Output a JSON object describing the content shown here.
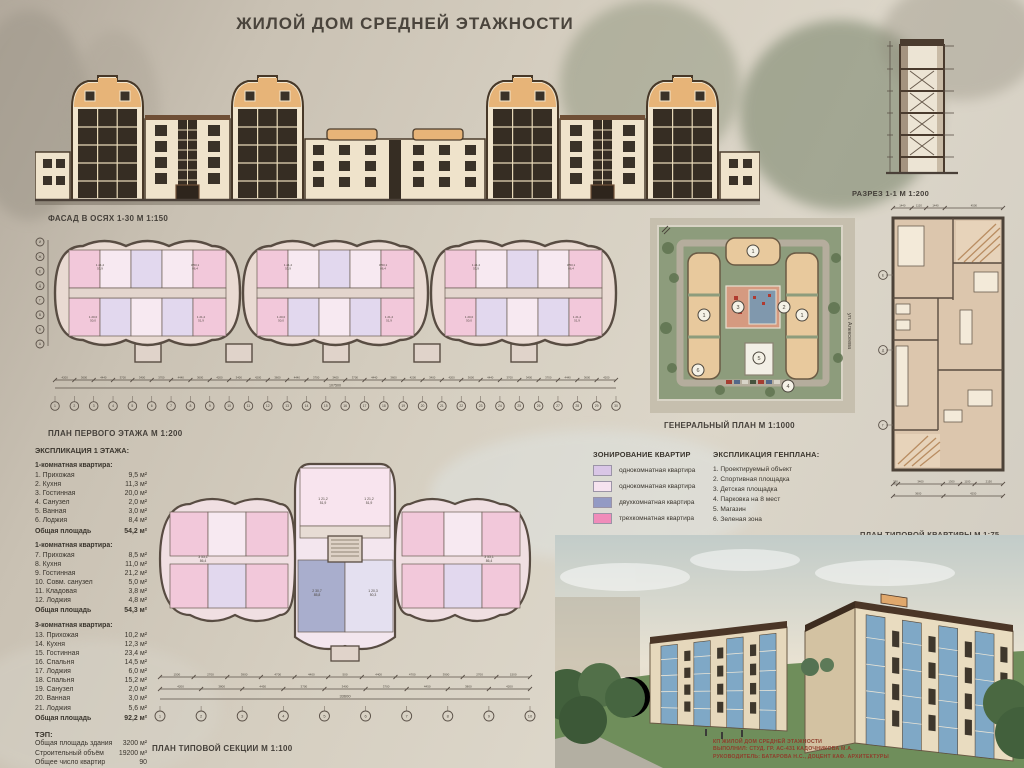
{
  "page": {
    "title": "ЖИЛОЙ ДОМ СРЕДНЕЙ ЭТАЖНОСТИ"
  },
  "facade": {
    "label": "ФАСАД В ОСЯХ 1-30 М 1:150"
  },
  "section_drawing": {
    "label": "РАЗРЕЗ 1-1 М 1:200"
  },
  "first_floor": {
    "label": "ПЛАН ПЕРВОГО ЭТАЖА М 1:200",
    "axes_h": [
      "1",
      "2",
      "3",
      "4",
      "5",
      "6",
      "7",
      "8",
      "9",
      "10",
      "11",
      "12",
      "13",
      "14",
      "15",
      "16",
      "17",
      "18",
      "19",
      "20",
      "21",
      "22",
      "23",
      "24",
      "25",
      "26",
      "27",
      "28",
      "29",
      "30"
    ],
    "axes_v": [
      "И",
      "Ж",
      "Е",
      "Д",
      "Г",
      "В",
      "Б",
      "А"
    ],
    "dims": [
      "4200",
      "3600",
      "4440",
      "3700",
      "3400",
      "3700",
      "4440",
      "3600",
      "4200",
      "3400",
      "4200",
      "3600",
      "4440",
      "3700",
      "3400",
      "3700",
      "4440",
      "3600",
      "4200",
      "3400",
      "4200",
      "3600",
      "4440",
      "3700",
      "3400",
      "3700",
      "4440",
      "3600",
      "4200"
    ],
    "total_dim": "107500",
    "apt_labels": [
      [
        "1",
        "21,2",
        "53,9"
      ],
      [
        "3",
        "53,1",
        "86,4"
      ],
      [
        "1",
        "20,0",
        "50,0"
      ],
      [
        "1",
        "21,2",
        "51,9"
      ]
    ]
  },
  "general_plan": {
    "label": "ГЕНЕРАЛЬНЫЙ ПЛАН М 1:1000",
    "street": "ул. Алексеева",
    "markers": [
      "1",
      "1",
      "1",
      "2",
      "3",
      "4",
      "5",
      "6"
    ]
  },
  "zoning_legend": {
    "title": "ЗОНИРОВАНИЕ КВАРТИР",
    "items": [
      {
        "color": "#d9c6e6",
        "label": "однокомнатная квартира"
      },
      {
        "color": "#f6e3ef",
        "label": "однокомнатная квартира"
      },
      {
        "color": "#939ac4",
        "label": "двухкомнатная квартира"
      },
      {
        "color": "#f08cba",
        "label": "трехкомнатная квартира"
      }
    ]
  },
  "genplan_legend": {
    "title": "ЭКСПЛИКАЦИЯ ГЕНПЛАНА:",
    "items": [
      "1. Проектируемый объект",
      "2. Спортивная площадка",
      "3. Детская площадка",
      "4. Парковка на 8 мест",
      "5. Магазин",
      "6. Зеленая зона"
    ]
  },
  "apartment_plan": {
    "label": "ПЛАН ТИПОВОЙ КВАРТИРЫ М 1:75",
    "axes_v": [
      "Е",
      "Д",
      "Г"
    ],
    "top_dims": [
      "1440",
      "1120",
      "1440",
      "4500"
    ],
    "bottom_dims_1": [
      "380",
      "3400",
      "1300",
      "1100",
      "2150"
    ],
    "bottom_dims_2": [
      "3600",
      "4250"
    ]
  },
  "typical_section": {
    "label": "ПЛАН ТИПОВОЙ СЕКЦИИ М 1:100",
    "axes_h": [
      "1",
      "2",
      "3",
      "4",
      "5",
      "6",
      "7",
      "8",
      "9",
      "10"
    ],
    "dims_row1": [
      "1500",
      "2700",
      "3900",
      "4700",
      "4400",
      "500",
      "4400",
      "4700",
      "3900",
      "2700",
      "1500"
    ],
    "dims_row2": [
      "4200",
      "3800",
      "4450",
      "3700",
      "3400",
      "3700",
      "4450",
      "3800",
      "4200"
    ],
    "total_dim": "33600",
    "apt_labels": [
      [
        "1",
        "21,2",
        "51,9"
      ],
      [
        "3",
        "53,1",
        "86,4"
      ],
      [
        "2",
        "30,7",
        "85,8"
      ],
      [
        "1",
        "20,3",
        "50,3"
      ]
    ]
  },
  "explication": {
    "title": "ЭКСПЛИКАЦИЯ 1 ЭТАЖА:",
    "groups": [
      {
        "title": "1-комнатная квартира:",
        "rows": [
          [
            "1. Прихожая",
            "9,5 м²"
          ],
          [
            "2. Кухня",
            "11,3 м²"
          ],
          [
            "3. Гостинная",
            "20,0 м²"
          ],
          [
            "4. Санузел",
            "2,0 м²"
          ],
          [
            "5. Ванная",
            "3,0 м²"
          ],
          [
            "6. Лоджия",
            "8,4 м²"
          ]
        ],
        "total": [
          "Общая площадь",
          "54,2 м²"
        ]
      },
      {
        "title": "1-комнатная квартира:",
        "rows": [
          [
            "7. Прихожая",
            "8,5 м²"
          ],
          [
            "8. Кухня",
            "11,0 м²"
          ],
          [
            "9. Гостинная",
            "21,2 м²"
          ],
          [
            "10. Совм. санузел",
            "5,0 м²"
          ],
          [
            "11. Кладовая",
            "3,8 м²"
          ],
          [
            "12. Лоджия",
            "4,8 м²"
          ]
        ],
        "total": [
          "Общая площадь",
          "54,3 м²"
        ]
      },
      {
        "title": "3-комнатная квартира:",
        "rows": [
          [
            "13. Прихожая",
            "10,2 м²"
          ],
          [
            "14. Кухня",
            "12,3 м²"
          ],
          [
            "15. Гостинная",
            "23,4 м²"
          ],
          [
            "16. Спальня",
            "14,5 м²"
          ],
          [
            "17. Лоджия",
            "6,0 м²"
          ],
          [
            "18. Спальня",
            "15,2 м²"
          ],
          [
            "19. Санузел",
            "2,0 м²"
          ],
          [
            "20. Ванная",
            "3,0 м²"
          ],
          [
            "21. Лоджия",
            "5,6 м²"
          ]
        ],
        "total": [
          "Общая площадь",
          "92,2 м²"
        ]
      }
    ],
    "tep": {
      "title": "ТЭП:",
      "rows": [
        [
          "Общая площадь здания",
          "3200 м²"
        ],
        [
          "Строительный объём",
          "19200 м³"
        ],
        [
          "Общее число квартир",
          "90"
        ]
      ]
    }
  },
  "titleblock": {
    "lines": [
      "КП ЖИЛОЙ ДОМ СРЕДНЕЙ ЭТАЖНОСТИ",
      "ВЫПОЛНИЛ: СТУД. ГР. АС-431 КАДОЧНИКОВА М.А.",
      "РУКОВОДИТЕЛЬ: БАТАРОВА Н.С., ДОЦЕНТ КАФ. АРХИТЕКТУРЫ"
    ]
  }
}
